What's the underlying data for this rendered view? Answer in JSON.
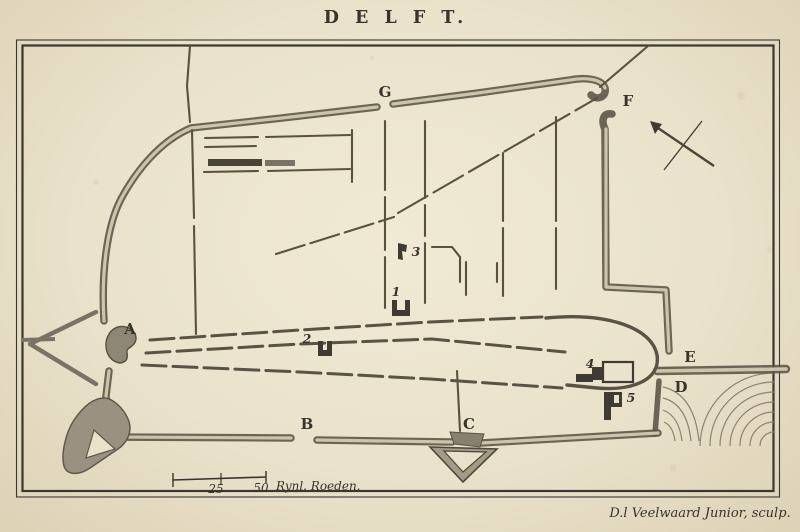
{
  "title": "D E L F T.",
  "markers": {
    "A": "A",
    "B": "B",
    "C": "C",
    "D": "D",
    "E": "E",
    "F": "F",
    "G": "G"
  },
  "numbers": {
    "n1": "1",
    "n2": "2",
    "n3": "3",
    "n4": "4",
    "n5": "5"
  },
  "scale_bar": {
    "mid_value": "25",
    "end_value": "50",
    "unit": "Rynl. Roeden."
  },
  "credit": "D.l Veelwaard Junior, sculp.",
  "icons": {
    "compass": "compass-needle-arrow-pointing-northwest"
  },
  "colors": {
    "paper": "#e9e1ca",
    "ink": "#38342b",
    "wall_dark": "#5a5344",
    "wall_light": "#cdc4aa",
    "shade": "#8f8776"
  }
}
